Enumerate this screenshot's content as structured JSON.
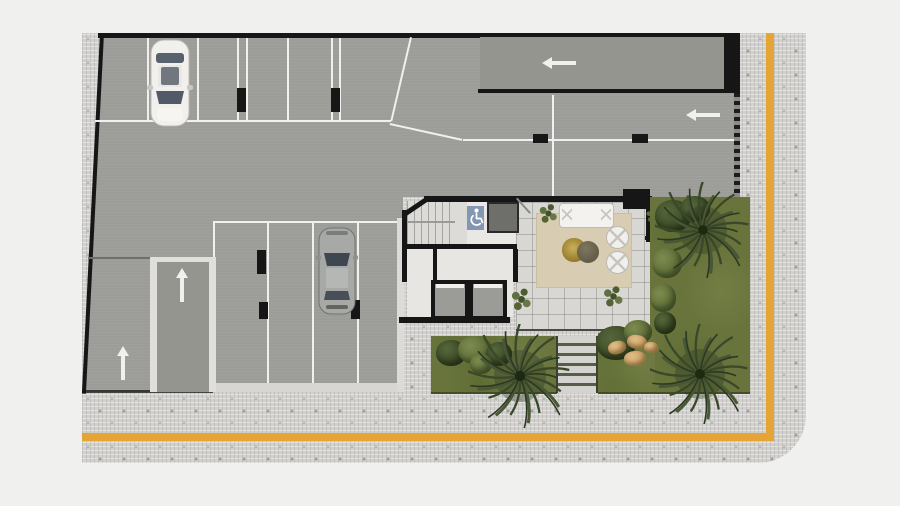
{
  "canvas": {
    "width_px": 900,
    "height_px": 506,
    "background_color": "#f0f0ef"
  },
  "plan_kind": "architectural ground-floor plan: parking garage, building core, lobby, gardens and street sidewalk",
  "colors": {
    "asphalt": "#9c9c99",
    "walls": "#161616",
    "lane_markings": "#f0f0ee",
    "sidewalk_pavers": "#d2d1cd",
    "tactile_stripe": "#e4a436",
    "lobby_tile": "#d8d7d3",
    "rug": "#d8ccb2",
    "grass": "#68743c",
    "accessible_blue": "#8397b2",
    "elevator_equipment_gray": "#6e6e6b",
    "boulder_tan": "#c29a60"
  },
  "sidewalk": {
    "shape": "L-shaped strip along right and bottom edges",
    "corner": "rounded bottom-right corner",
    "tactile_stripe": {
      "color": "#e4a436",
      "layout": "vertical stripe near right edge turning into horizontal stripe near bottom edge"
    }
  },
  "parking": {
    "rows": [
      {
        "id": "top-row",
        "stalls": 6,
        "occupied_stalls": 1,
        "column_wheel_stops": 2
      },
      {
        "id": "right-row",
        "stalls": 2,
        "column_wheel_stops": 2
      },
      {
        "id": "bottom-row",
        "stalls": 4,
        "occupied_stalls": 1,
        "column_wheel_stops": 3
      }
    ],
    "vehicles": [
      {
        "type": "car",
        "color": "white",
        "facing": "down",
        "location": "top-row second stall"
      },
      {
        "type": "car",
        "color": "silver",
        "facing": "up",
        "location": "bottom-row third stall"
      }
    ],
    "traffic_arrows": [
      {
        "direction": "left",
        "area": "upper entry ramp"
      },
      {
        "direction": "left",
        "area": "entry lane from street"
      },
      {
        "direction": "up",
        "area": "inner ramp between walls"
      },
      {
        "direction": "up",
        "area": "left exit lane"
      }
    ],
    "ramp_wall_color": "#e0dfdb"
  },
  "building_core": {
    "stairs": {
      "flights": 2
    },
    "elevator_shafts": 2,
    "equipment_square": {
      "color": "#6e6e6b"
    },
    "accessible_zone": {
      "icon": "wheelchair-icon",
      "background": "#8397b2"
    }
  },
  "lobby": {
    "floor": "tile grid",
    "rug": {
      "color": "#d8ccb2"
    },
    "furniture": [
      {
        "item": "sofa",
        "color": "white"
      },
      {
        "item": "coffee-table",
        "color": "olive-brown"
      },
      {
        "item": "round-chair",
        "count": 2,
        "color": "white"
      },
      {
        "item": "planter-shrub",
        "count": 4
      }
    ]
  },
  "landscaping": {
    "palm_trees": 3,
    "garden_beds": 3,
    "boulders": 4,
    "exterior_step_treads": 6,
    "bushes": "multiple dark and light green clusters"
  }
}
